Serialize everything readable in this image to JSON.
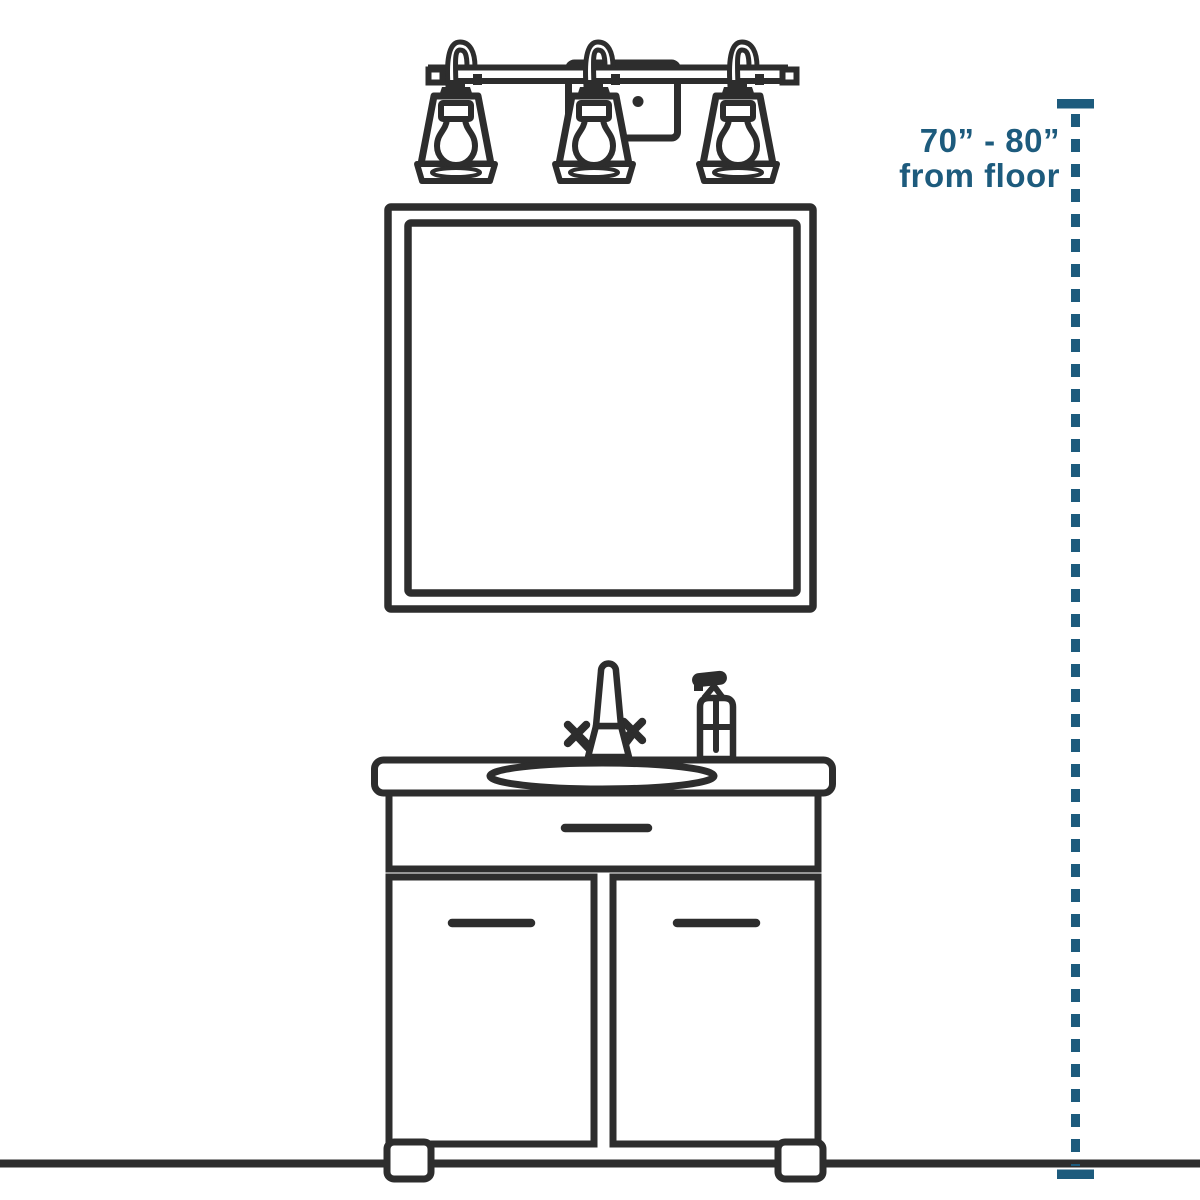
{
  "annotation": {
    "line1": "70” - 80”",
    "line2": "from floor"
  },
  "colors": {
    "accent": "#1d5b7d",
    "line": "#2d2d2d",
    "bg": "#ffffff"
  },
  "scene": {
    "description_components": [
      {
        "name": "three-light-vanity-fixture"
      },
      {
        "name": "fixture-mounting-plate"
      },
      {
        "name": "wall-mirror"
      },
      {
        "name": "faucet-with-cross-handles"
      },
      {
        "name": "soap-pump-bottle"
      },
      {
        "name": "vanity-countertop-with-oval-sink"
      },
      {
        "name": "two-door-vanity-cabinet"
      },
      {
        "name": "floor-line"
      },
      {
        "name": "height-measurement-guide"
      }
    ]
  }
}
